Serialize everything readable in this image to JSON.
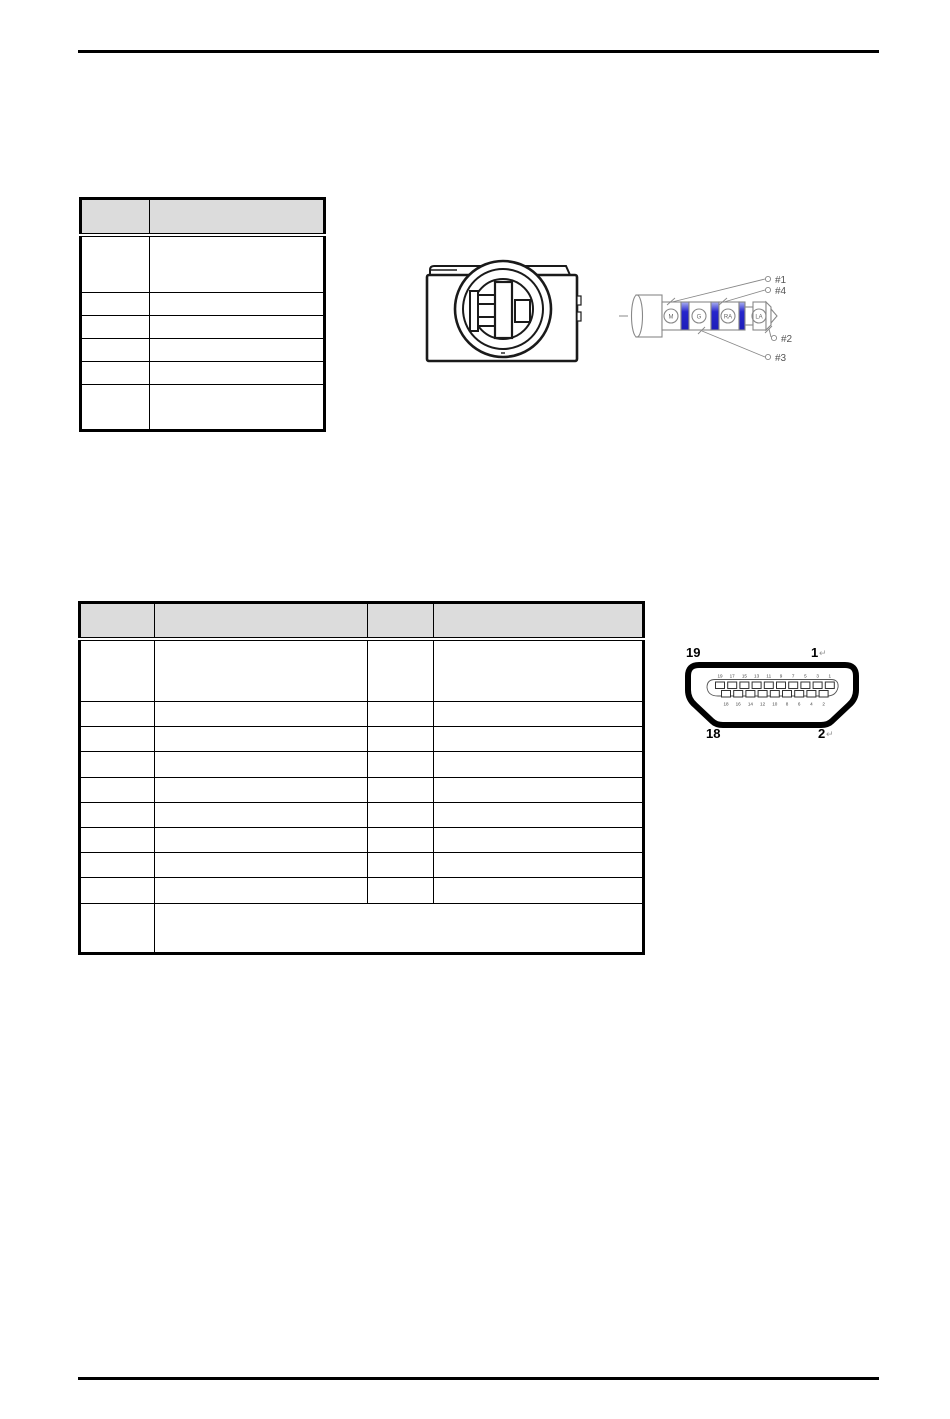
{
  "audio_table": {
    "header": [
      "",
      ""
    ],
    "rows": [
      [
        "",
        ""
      ],
      [
        "",
        ""
      ],
      [
        "",
        ""
      ],
      [
        "",
        ""
      ],
      [
        "",
        ""
      ],
      [
        "",
        ""
      ]
    ]
  },
  "hdmi_table": {
    "header": [
      "",
      "",
      "",
      ""
    ],
    "rows": [
      [
        "",
        "",
        "",
        ""
      ],
      [
        "",
        "",
        "",
        ""
      ],
      [
        "",
        "",
        "",
        ""
      ],
      [
        "",
        "",
        "",
        ""
      ],
      [
        "",
        "",
        "",
        ""
      ],
      [
        "",
        "",
        "",
        ""
      ],
      [
        "",
        "",
        "",
        ""
      ],
      [
        "",
        "",
        "",
        ""
      ],
      [
        "",
        "",
        "",
        ""
      ],
      [
        "",
        ""
      ]
    ]
  },
  "jack_plug": {
    "segments": [
      "M",
      "G",
      "RA",
      "LA"
    ],
    "callouts": [
      "#1",
      "#4",
      "#2",
      "#3"
    ]
  },
  "hdmi_connector": {
    "corner_labels": {
      "top_left": "19",
      "top_right": "1",
      "bottom_left": "18",
      "bottom_right": "2"
    },
    "return_mark": "↵",
    "top_pins": [
      "19",
      "17",
      "15",
      "13",
      "11",
      "9",
      "7",
      "5",
      "3",
      "1"
    ],
    "bottom_pins": [
      "18",
      "16",
      "14",
      "12",
      "10",
      "8",
      "6",
      "4",
      "2"
    ]
  },
  "colors": {
    "table_header_fill": "#dcdcdc",
    "table_border": "#000000",
    "ring_blue": "#2626cc",
    "line_gray": "#888888",
    "jack_line": "#1a1a1a"
  }
}
